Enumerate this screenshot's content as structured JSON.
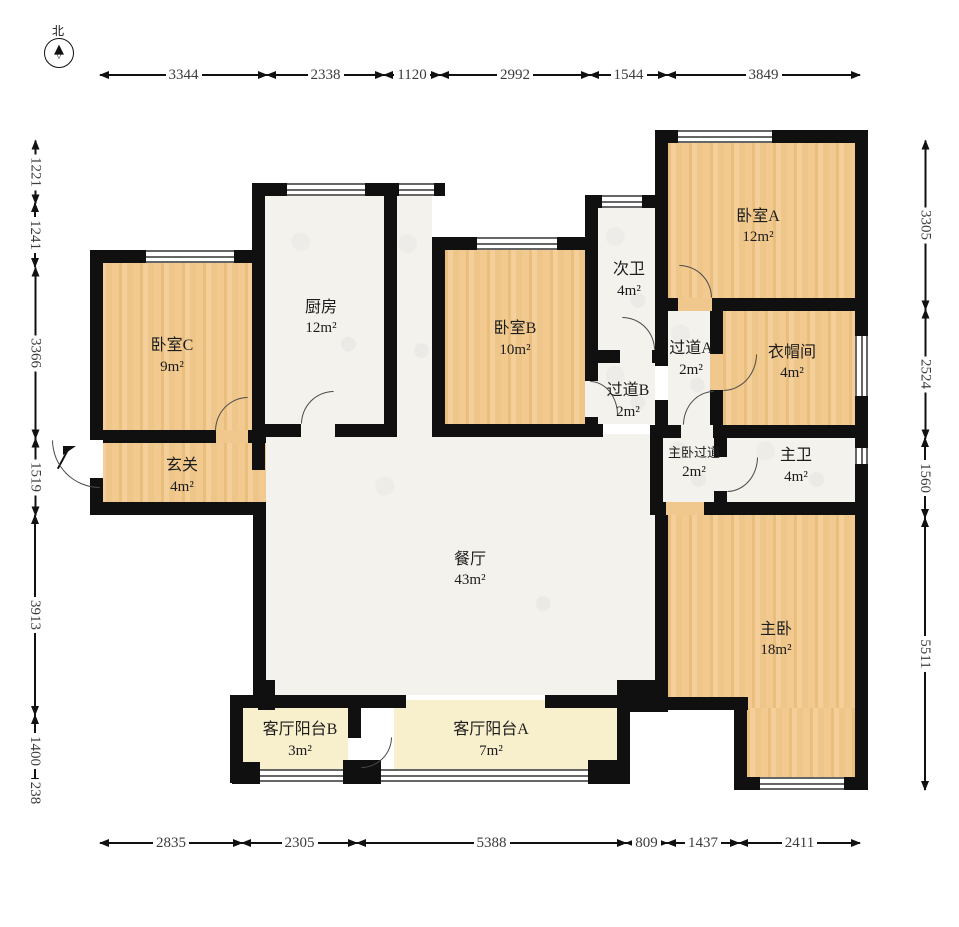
{
  "compass": {
    "north_label": "北"
  },
  "dimensions": {
    "top": [
      "3344",
      "2338",
      "1120",
      "2992",
      "1544",
      "3849"
    ],
    "bottom": [
      "2835",
      "2305",
      "5388",
      "809",
      "1437",
      "2411"
    ],
    "left": [
      "1221",
      "1241",
      "3366",
      "1519",
      "3913",
      "1400",
      "238"
    ],
    "right": [
      "3305",
      "2524",
      "1560",
      "5511"
    ]
  },
  "rooms": {
    "bedroom_a": {
      "name": "卧室A",
      "area": "12m²"
    },
    "bedroom_b": {
      "name": "卧室B",
      "area": "10m²"
    },
    "bedroom_c": {
      "name": "卧室C",
      "area": "9m²"
    },
    "kitchen": {
      "name": "厨房",
      "area": "12m²"
    },
    "bath_second": {
      "name": "次卫",
      "area": "4m²"
    },
    "corridor_a": {
      "name": "过道A",
      "area": "2m²"
    },
    "corridor_b": {
      "name": "过道B",
      "area": "2m²"
    },
    "closet": {
      "name": "衣帽间",
      "area": "4m²"
    },
    "entry": {
      "name": "玄关",
      "area": "4m²"
    },
    "master_corridor": {
      "name": "主卧过道",
      "area": "2m²"
    },
    "master_bath": {
      "name": "主卫",
      "area": "4m²"
    },
    "dining": {
      "name": "餐厅",
      "area": "43m²"
    },
    "master_bedroom": {
      "name": "主卧",
      "area": "18m²"
    },
    "balcony_b": {
      "name": "客厅阳台B",
      "area": "3m²"
    },
    "balcony_a": {
      "name": "客厅阳台A",
      "area": "7m²"
    }
  },
  "colors": {
    "wood": "#f0c78c",
    "tile": "#f4f2ed",
    "balcony": "#f8efcd",
    "wall": "#101010",
    "dimension_text": "#3c3c3c"
  }
}
